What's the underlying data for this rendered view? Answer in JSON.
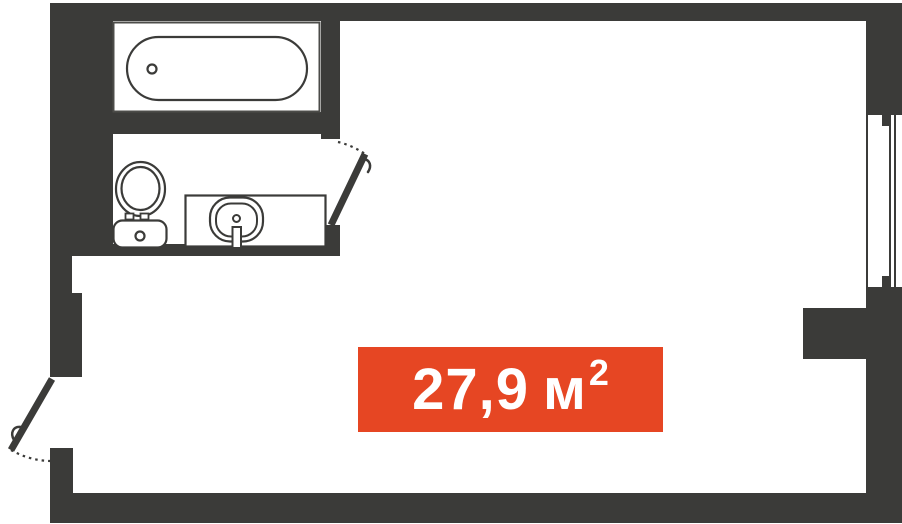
{
  "colors": {
    "wall": "#3B3B39",
    "accent": "#E64623",
    "label_text": "#FFFFFF",
    "background": "#FFFFFF",
    "fixture_outline": "#3B3B39"
  },
  "area_label": {
    "number": "27,9",
    "unit": "м",
    "sup": "2",
    "full_text": "27,9 м²"
  },
  "fixtures": {
    "bathroom": [
      "bathtub",
      "toilet",
      "sink"
    ],
    "openings": [
      "entrance-door",
      "bathroom-door",
      "window"
    ]
  }
}
